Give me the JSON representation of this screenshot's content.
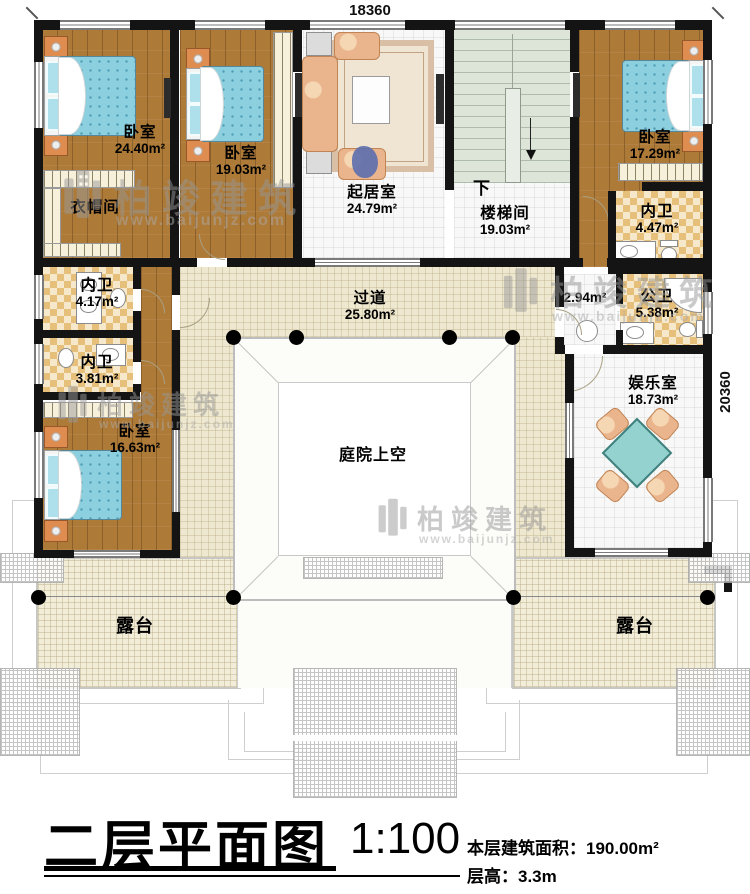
{
  "plan": {
    "dim_top": "18360",
    "dim_right": "20360",
    "rooms": {
      "bedroom1": {
        "name": "卧室",
        "area": "24.40m²"
      },
      "bedroom2": {
        "name": "卧室",
        "area": "19.03m²"
      },
      "living": {
        "name": "起居室",
        "area": "24.79m²"
      },
      "stairs_down": {
        "name": "下"
      },
      "stairwell": {
        "name": "楼梯间",
        "area": "19.03m²"
      },
      "bedroom3": {
        "name": "卧室",
        "area": "17.29m²"
      },
      "cloakroom": {
        "name": "衣帽间"
      },
      "ensuite3": {
        "name": "内卫",
        "area": "4.47m²"
      },
      "ensuite1": {
        "name": "内卫",
        "area": "4.17m²"
      },
      "ensuite2": {
        "name": "内卫",
        "area": "3.81m²"
      },
      "corridor": {
        "name": "过道",
        "area": "25.80m²"
      },
      "vestibule": {
        "area": "2.94m²"
      },
      "public_bath": {
        "name": "公卫",
        "area": "5.38m²"
      },
      "bedroom4": {
        "name": "卧室",
        "area": "16.63m²"
      },
      "recreation": {
        "name": "娱乐室",
        "area": "18.73m²"
      },
      "courtyard": {
        "name": "庭院上空"
      },
      "terrace_left": {
        "name": "露台"
      },
      "terrace_right": {
        "name": "露台"
      }
    }
  },
  "watermark": {
    "brand": "柏竣建筑",
    "url": "www.baijunjz.com"
  },
  "title_block": {
    "title": "二层平面图",
    "scale": "1:100",
    "floor_area_label": "本层建筑面积：",
    "floor_area_value": "190.00m²",
    "floor_height_label": "层高：",
    "floor_height_value": "3.3m"
  }
}
